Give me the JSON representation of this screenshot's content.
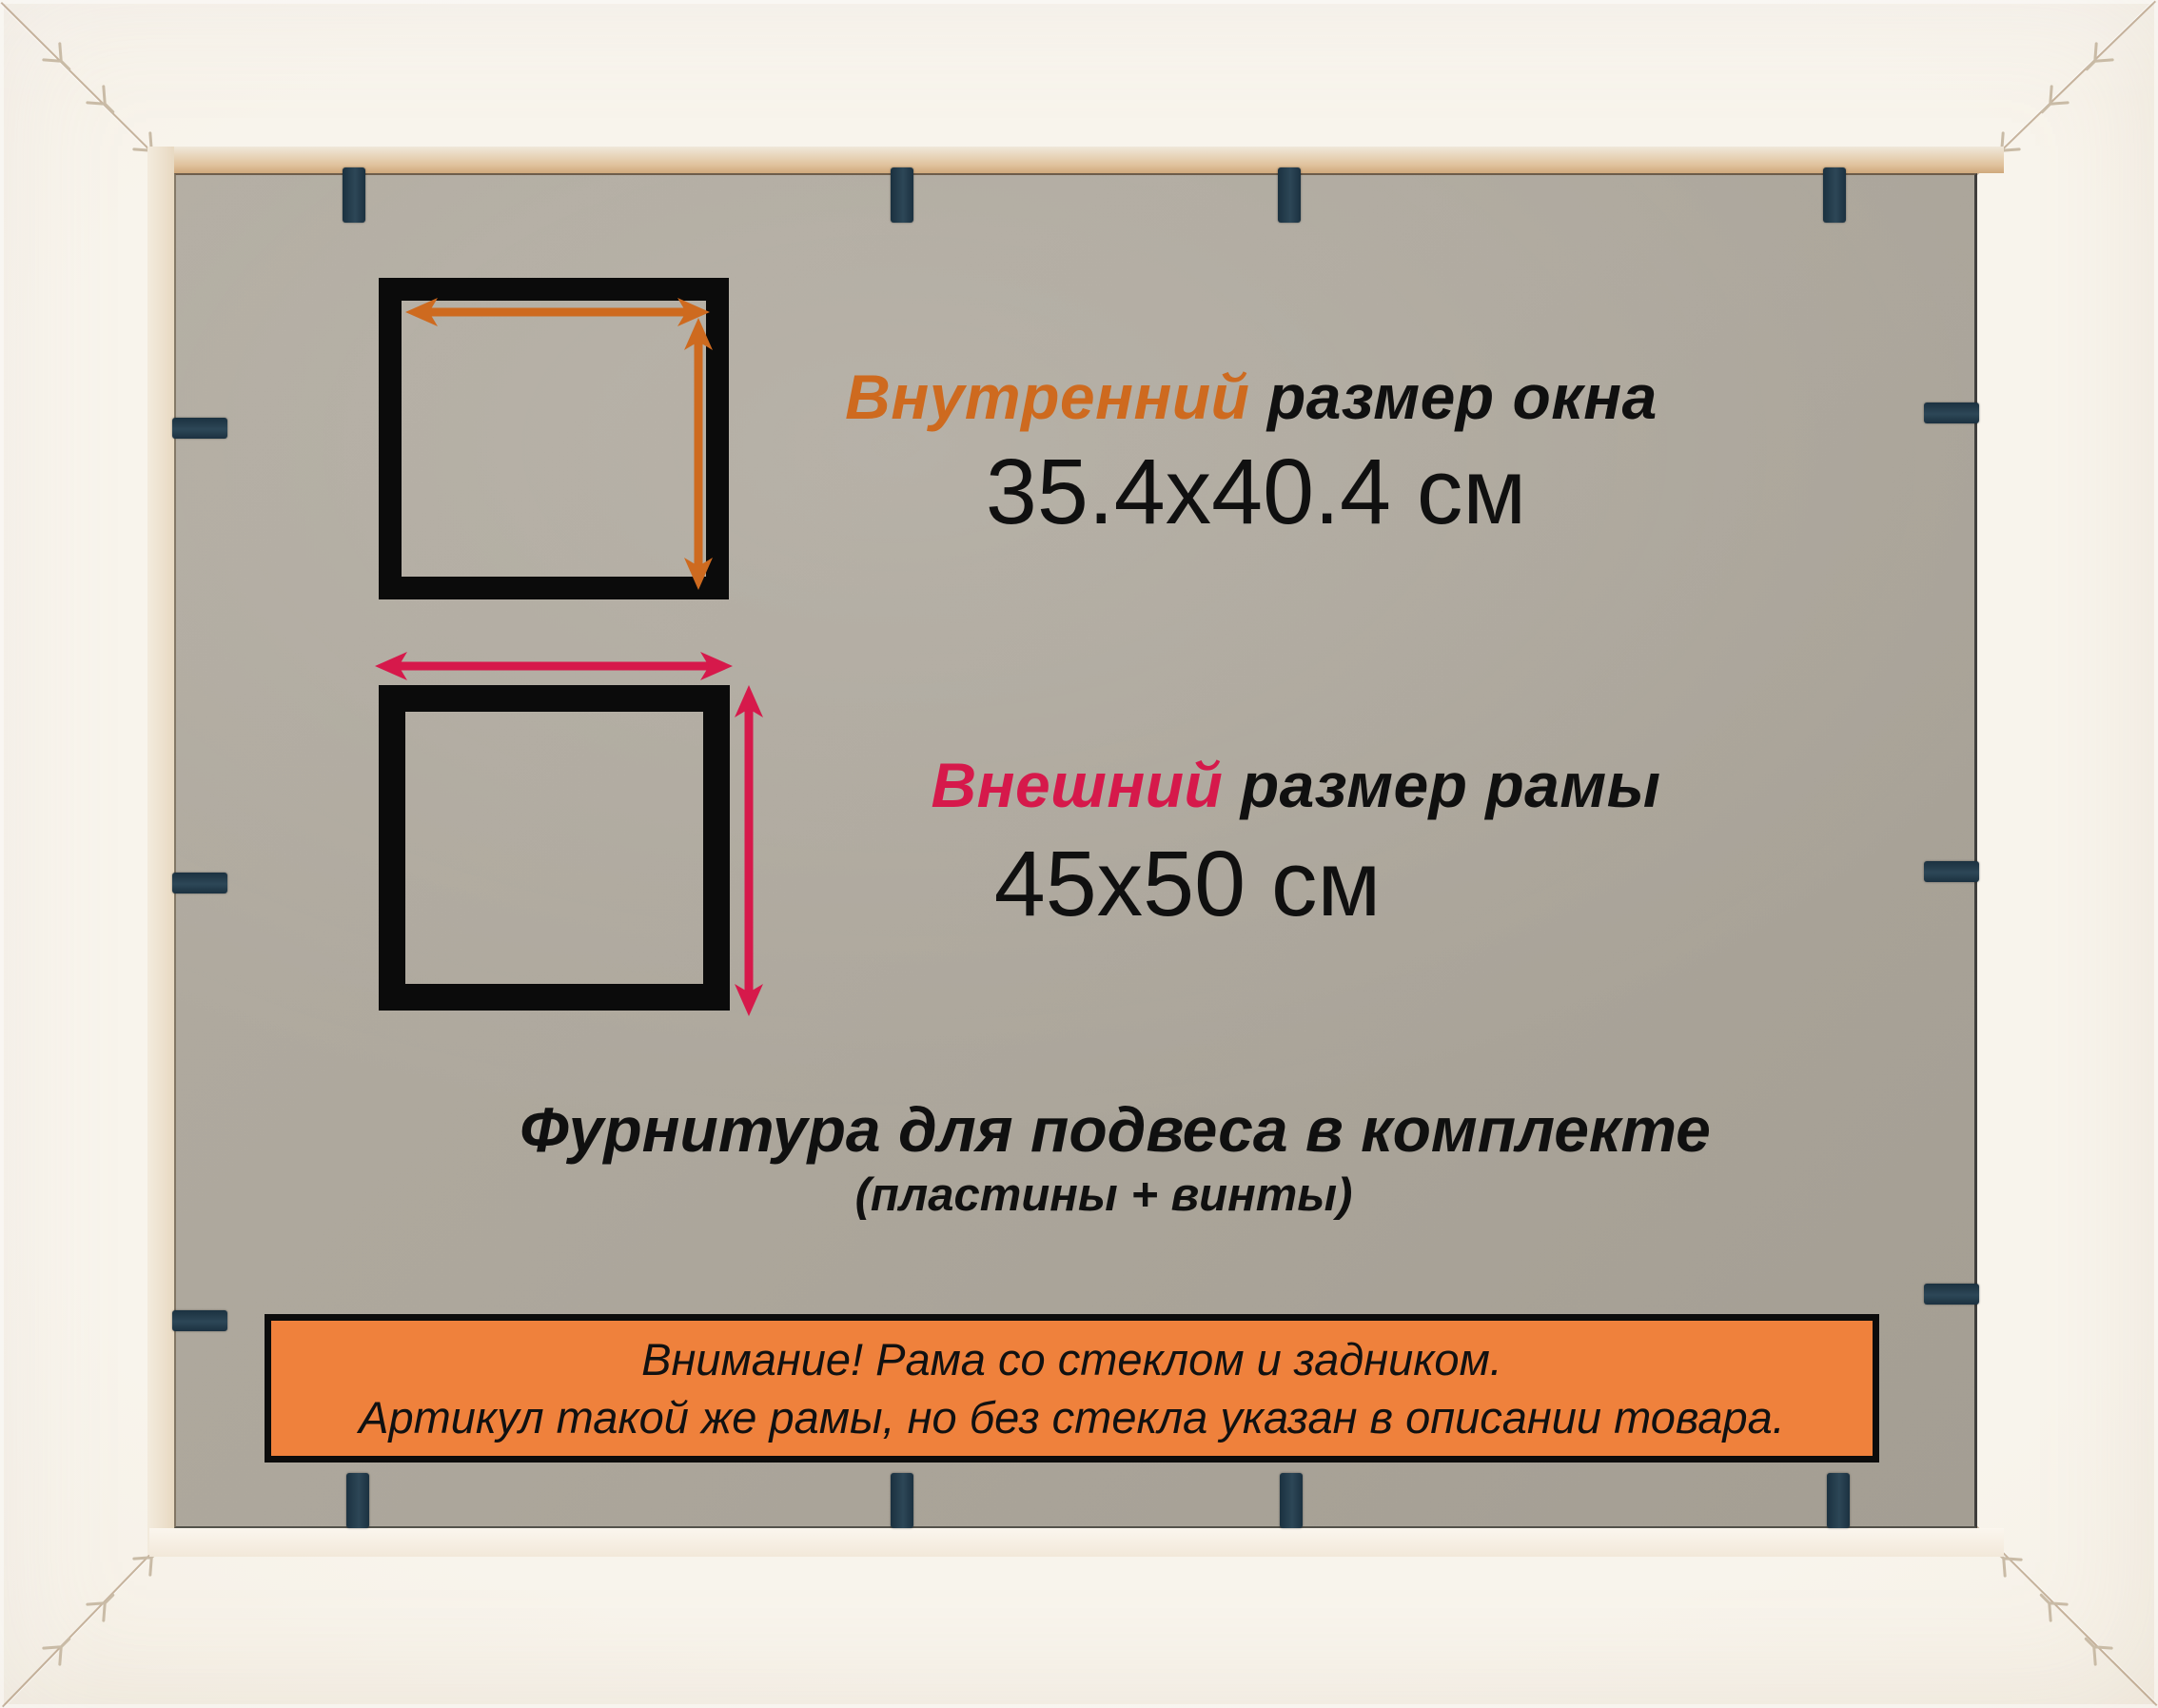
{
  "product_card": {
    "inner_size": {
      "label_accent": "Внутренний",
      "label_rest": "размер окна",
      "value": "35.4x40.4 см"
    },
    "outer_size": {
      "label_accent": "Внешний",
      "label_rest": "размер рамы",
      "value": "45x50 см"
    },
    "hardware_note": {
      "title": "Фурнитура для подвеса в комплекте",
      "subtitle": "(пластины + винты)"
    },
    "notice_banner": {
      "line1": "Внимание! Рама со стеклом и задником.",
      "line2": "Артикул такой же рамы, но без стекла указан в описании товара."
    }
  },
  "colors": {
    "accent_orange": "#CE6A1F",
    "accent_crimson": "#D6194B",
    "banner_orange": "#EF813C",
    "clip_navy": "#223A49",
    "backing_gray": "#ADA79C",
    "frame_cream": "#F6F1E8",
    "ink_black": "#0D0D0D"
  },
  "icons": {
    "inner_width_arrow": "double-headed-arrow-horizontal",
    "inner_height_arrow": "double-headed-arrow-vertical",
    "outer_width_arrow": "double-headed-arrow-horizontal",
    "outer_height_arrow": "double-headed-arrow-vertical",
    "retainer_clip": "metal-retainer-clip",
    "corner_staple": "v-nail-staple"
  }
}
